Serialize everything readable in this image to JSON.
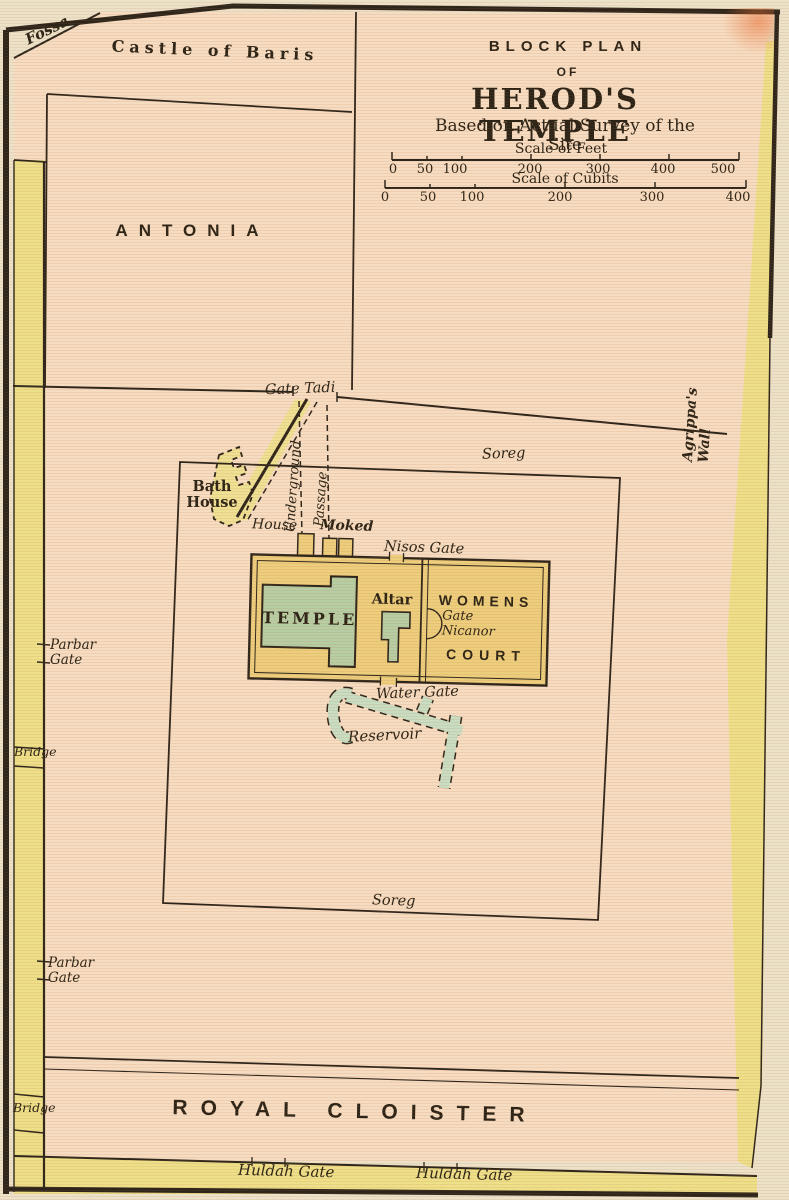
{
  "title": {
    "kicker": "BLOCK PLAN",
    "of": "OF",
    "main": "HEROD'S TEMPLE",
    "subtitle": "Based on Actual Survey of the Site"
  },
  "scales": {
    "feet": {
      "title": "Scale of Feet",
      "ticks": [
        "0",
        "50",
        "100",
        "200",
        "300",
        "400",
        "500"
      ]
    },
    "cubits": {
      "title": "Scale of Cubits",
      "ticks": [
        "0",
        "50",
        "100",
        "200",
        "300",
        "400"
      ]
    }
  },
  "regions": {
    "fossa": "Fossa",
    "castle_of_baris": "Castle of Baris",
    "antonia": "ANTONIA",
    "agrippas_wall": "Agrippa's Wall",
    "royal_cloister": "ROYAL CLOISTER"
  },
  "gates": {
    "gate_tadi": "Gate Tadi",
    "nisos_gate": "Nisos Gate",
    "gate_nicanor": "Gate\nNicanor",
    "water_gate": "Water Gate",
    "parbar_gate": "Parbar\nGate",
    "huldah_gate": "Huldah Gate",
    "bridge": "Bridge"
  },
  "features": {
    "soreg": "Soreg",
    "temple": "TEMPLE",
    "altar": "Altar",
    "womens": "WOMENS",
    "court": "COURT",
    "bath_house": "Bath\nHouse",
    "underground": "Underground",
    "passage": "Passage",
    "house": "House",
    "moked": "Moked",
    "reservoir": "Reservoir"
  },
  "colors": {
    "paper_cream": "#ebe2c8",
    "map_pink": "#f6dcc0",
    "wall_yellow": "#ede089",
    "court_gold": "#ecce7c",
    "building_green": "#b7cda3",
    "reservoir_green": "#c9ddc1",
    "line_dark": "#2e261b"
  }
}
